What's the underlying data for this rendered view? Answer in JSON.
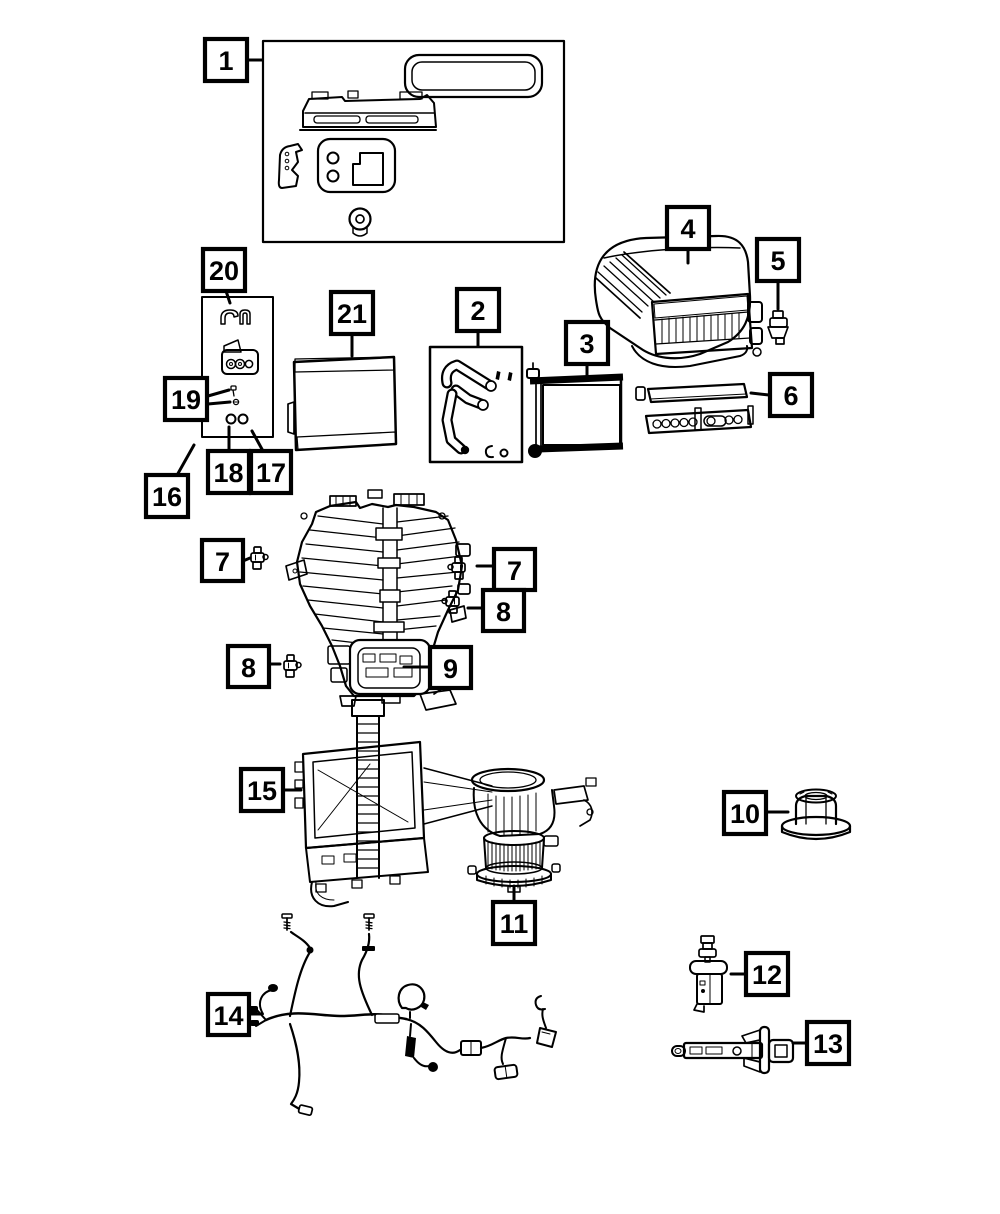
{
  "diagram": {
    "kind": "exploded-parts-line-art",
    "background_color": "#ffffff",
    "line_color": "#000000"
  },
  "callouts": {
    "p1": {
      "label": "1"
    },
    "p2": {
      "label": "2"
    },
    "p3": {
      "label": "3"
    },
    "p4": {
      "label": "4"
    },
    "p5": {
      "label": "5"
    },
    "p6": {
      "label": "6"
    },
    "p7a": {
      "label": "7"
    },
    "p7b": {
      "label": "7"
    },
    "p8a": {
      "label": "8"
    },
    "p8b": {
      "label": "8"
    },
    "p9": {
      "label": "9"
    },
    "p10": {
      "label": "10"
    },
    "p11": {
      "label": "11"
    },
    "p12": {
      "label": "12"
    },
    "p13": {
      "label": "13"
    },
    "p14": {
      "label": "14"
    },
    "p15": {
      "label": "15"
    },
    "p16": {
      "label": "16"
    },
    "p17": {
      "label": "17"
    },
    "p18": {
      "label": "18"
    },
    "p19": {
      "label": "19"
    },
    "p20": {
      "label": "20"
    },
    "p21": {
      "label": "21"
    }
  }
}
